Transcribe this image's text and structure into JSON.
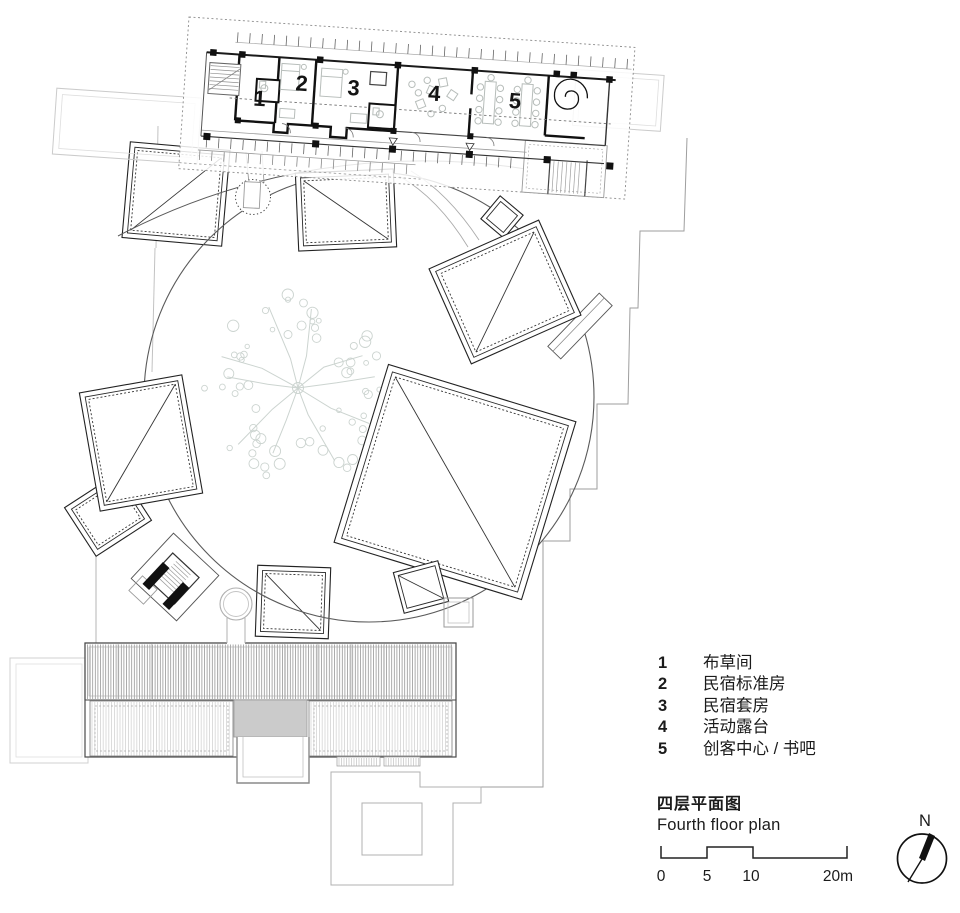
{
  "page": {
    "background": "#ffffff"
  },
  "plan": {
    "room_numbers": [
      "1",
      "2",
      "3",
      "4",
      "5"
    ]
  },
  "legend": {
    "items": [
      {
        "num": "1",
        "label": "布草间"
      },
      {
        "num": "2",
        "label": "民宿标准房"
      },
      {
        "num": "3",
        "label": "民宿套房"
      },
      {
        "num": "4",
        "label": "活动露台"
      },
      {
        "num": "5",
        "label": "创客中心 / 书吧"
      }
    ]
  },
  "title_block": {
    "title_zh": "四层平面图",
    "title_en": "Fourth floor plan"
  },
  "scale_bar": {
    "labels": [
      "0",
      "5",
      "10",
      "20m"
    ]
  },
  "north": {
    "label": "N"
  },
  "colors": {
    "ink": "#1a1a1a",
    "site_line": "#9e9e9e",
    "tree": "#ccd4d0",
    "furniture": "#b7bdba",
    "roof_gray_fill": "#cbcbcb"
  }
}
